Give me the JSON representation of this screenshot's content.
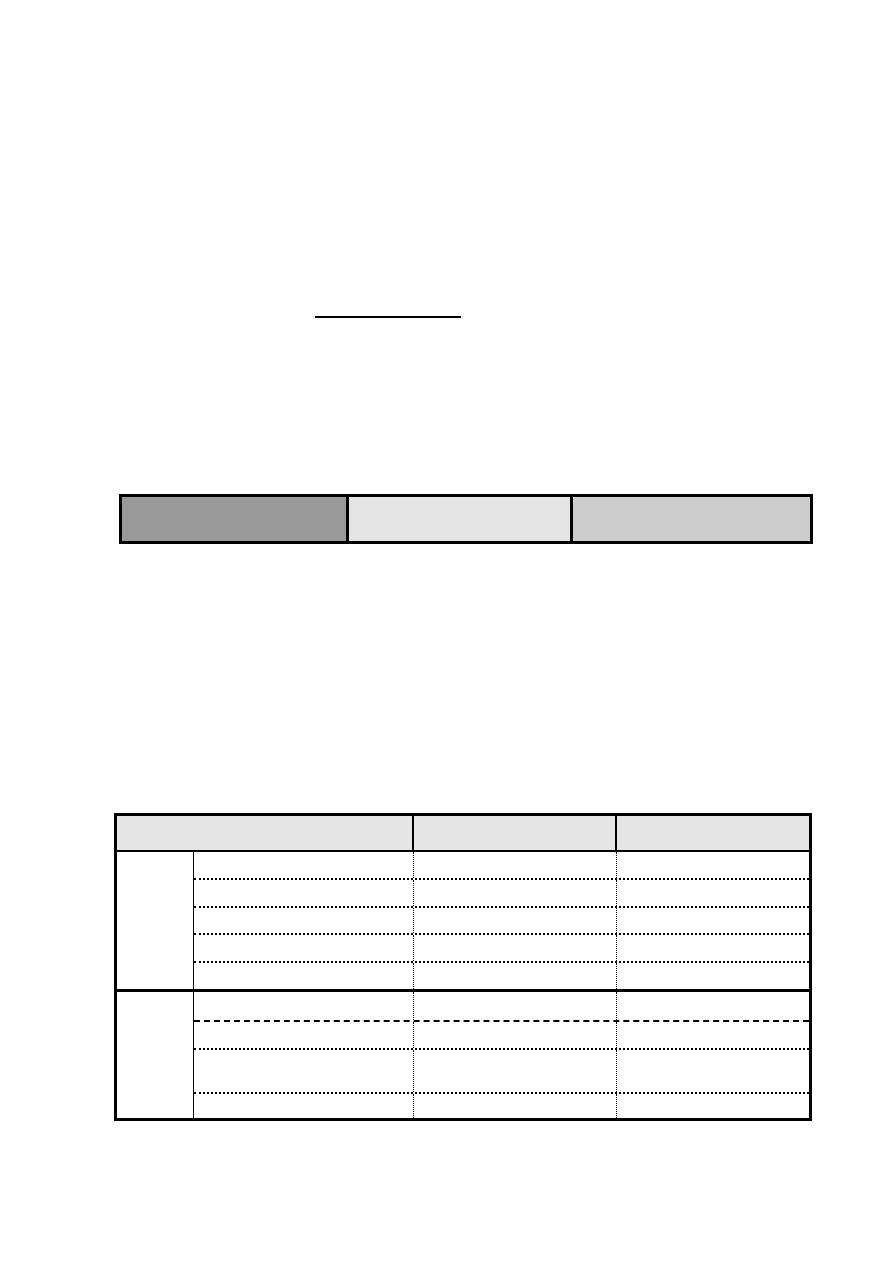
{
  "page": {
    "background": "#ffffff"
  },
  "divider_line": {
    "color": "#000000"
  },
  "color_bar": {
    "border_color": "#000000",
    "cells": [
      {
        "label": "",
        "fill": "#999999"
      },
      {
        "label": "",
        "fill": "#e5e5e5"
      },
      {
        "label": "",
        "fill": "#cccccc"
      }
    ]
  },
  "table": {
    "border_color": "#000000",
    "header": {
      "fill": "#e5e5e5",
      "columns": [
        {
          "label": ""
        },
        {
          "label": ""
        },
        {
          "label": ""
        }
      ]
    },
    "sections": [
      {
        "row_header": "",
        "rows": [
          [
            "",
            "",
            ""
          ],
          [
            "",
            "",
            ""
          ],
          [
            "",
            "",
            ""
          ],
          [
            "",
            "",
            ""
          ],
          [
            "",
            "",
            ""
          ]
        ]
      },
      {
        "row_header": "",
        "rows": [
          [
            "",
            "",
            ""
          ],
          [
            "",
            "",
            ""
          ],
          [
            "",
            "",
            ""
          ],
          [
            "",
            "",
            ""
          ]
        ]
      }
    ]
  }
}
